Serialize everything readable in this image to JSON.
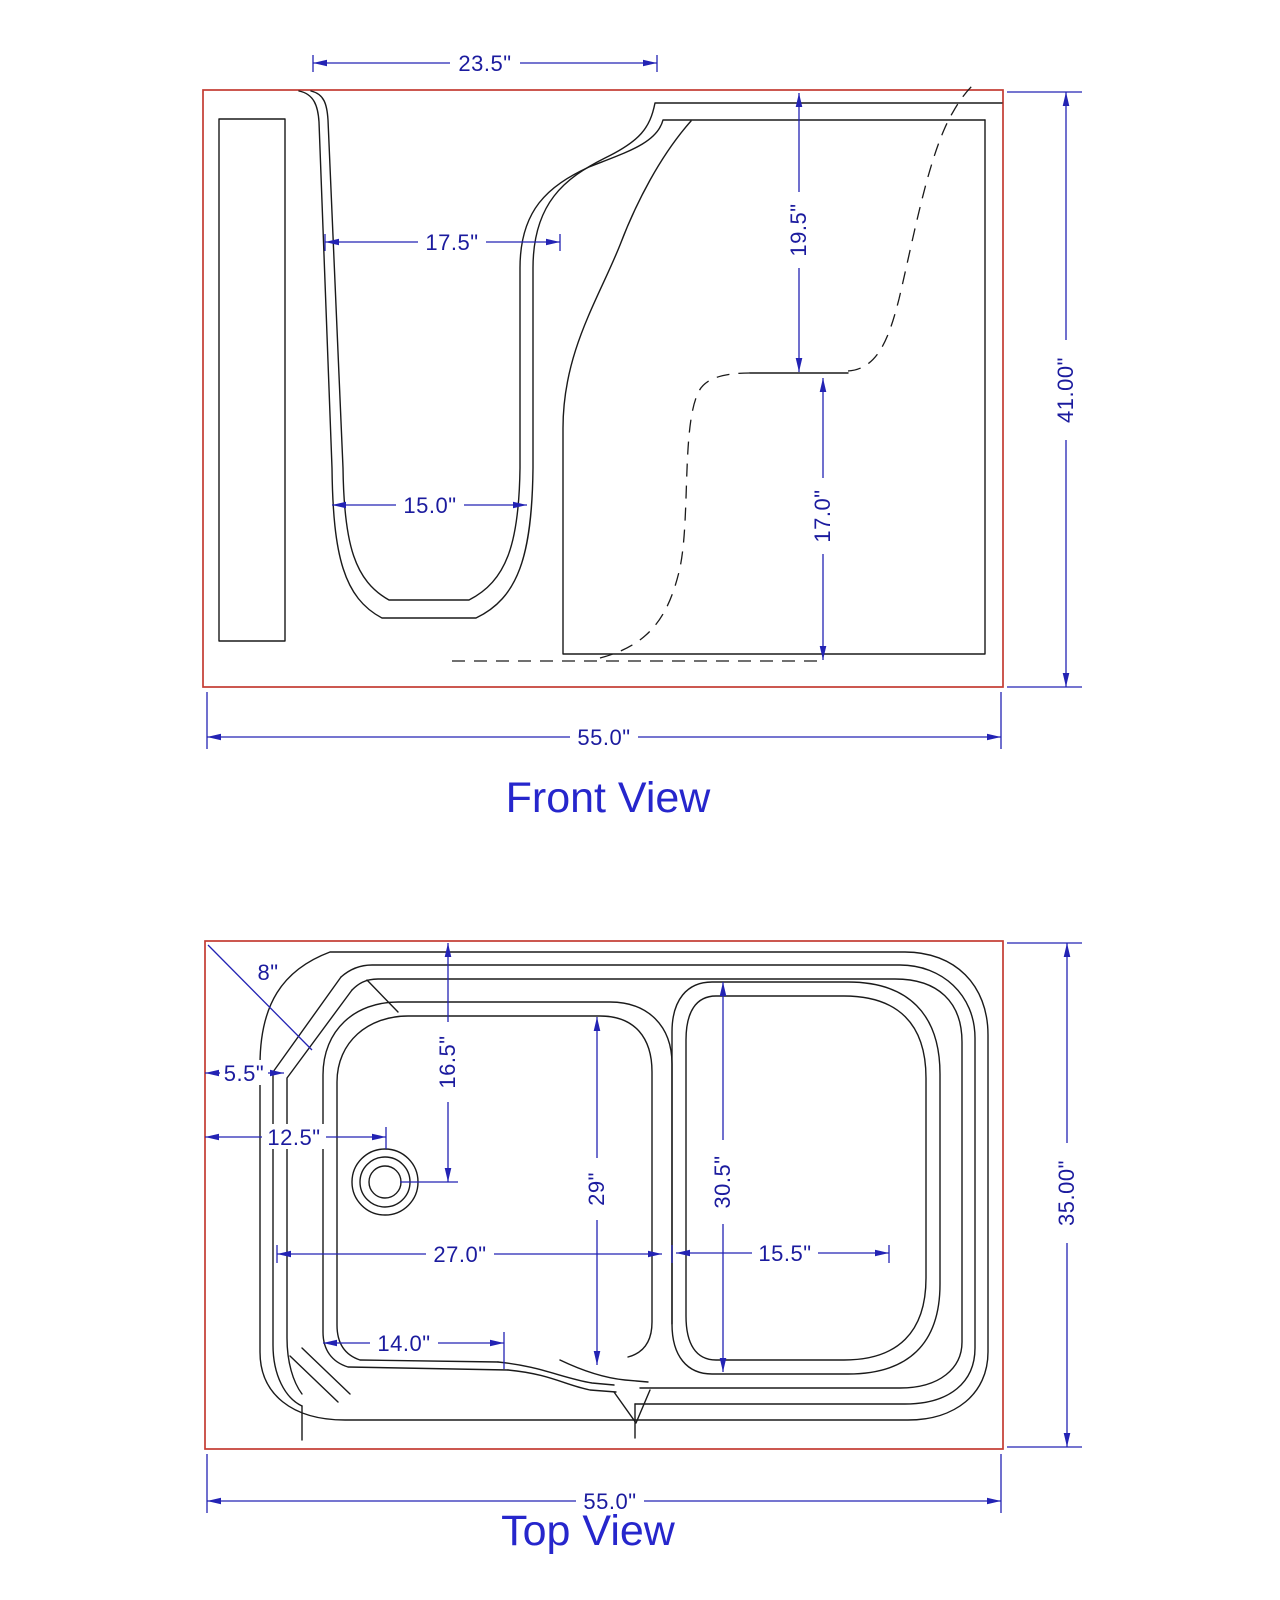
{
  "colors": {
    "envelope_red": "#c43b32",
    "drawing_black": "#1a1a1a",
    "dimension_blue": "#2323b4",
    "dimension_text_navy": "#1b1b9e",
    "title_blue": "#2626cc",
    "background": "#ffffff"
  },
  "front_view": {
    "title": "Front View",
    "dims": {
      "door_top_width": "23.5\"",
      "door_mid_width": "17.5\"",
      "footwell_width": "15.0\"",
      "upper_right_height": "19.5\"",
      "lower_right_height": "17.0\"",
      "overall_height": "41.00\"",
      "overall_width": "55.0\""
    }
  },
  "top_view": {
    "title": "Top View",
    "dims": {
      "corner_chamfer": "8\"",
      "rim_offset": "5.5\"",
      "drain_from_left": "12.5\"",
      "drain_from_top": "16.5\"",
      "footwell_length": "29\"",
      "basin_length": "30.5\"",
      "footwell_span": "27.0\"",
      "basin_width": "15.5\"",
      "door_opening_width": "14.0\"",
      "overall_depth": "35.00\"",
      "overall_width": "55.0\""
    }
  }
}
